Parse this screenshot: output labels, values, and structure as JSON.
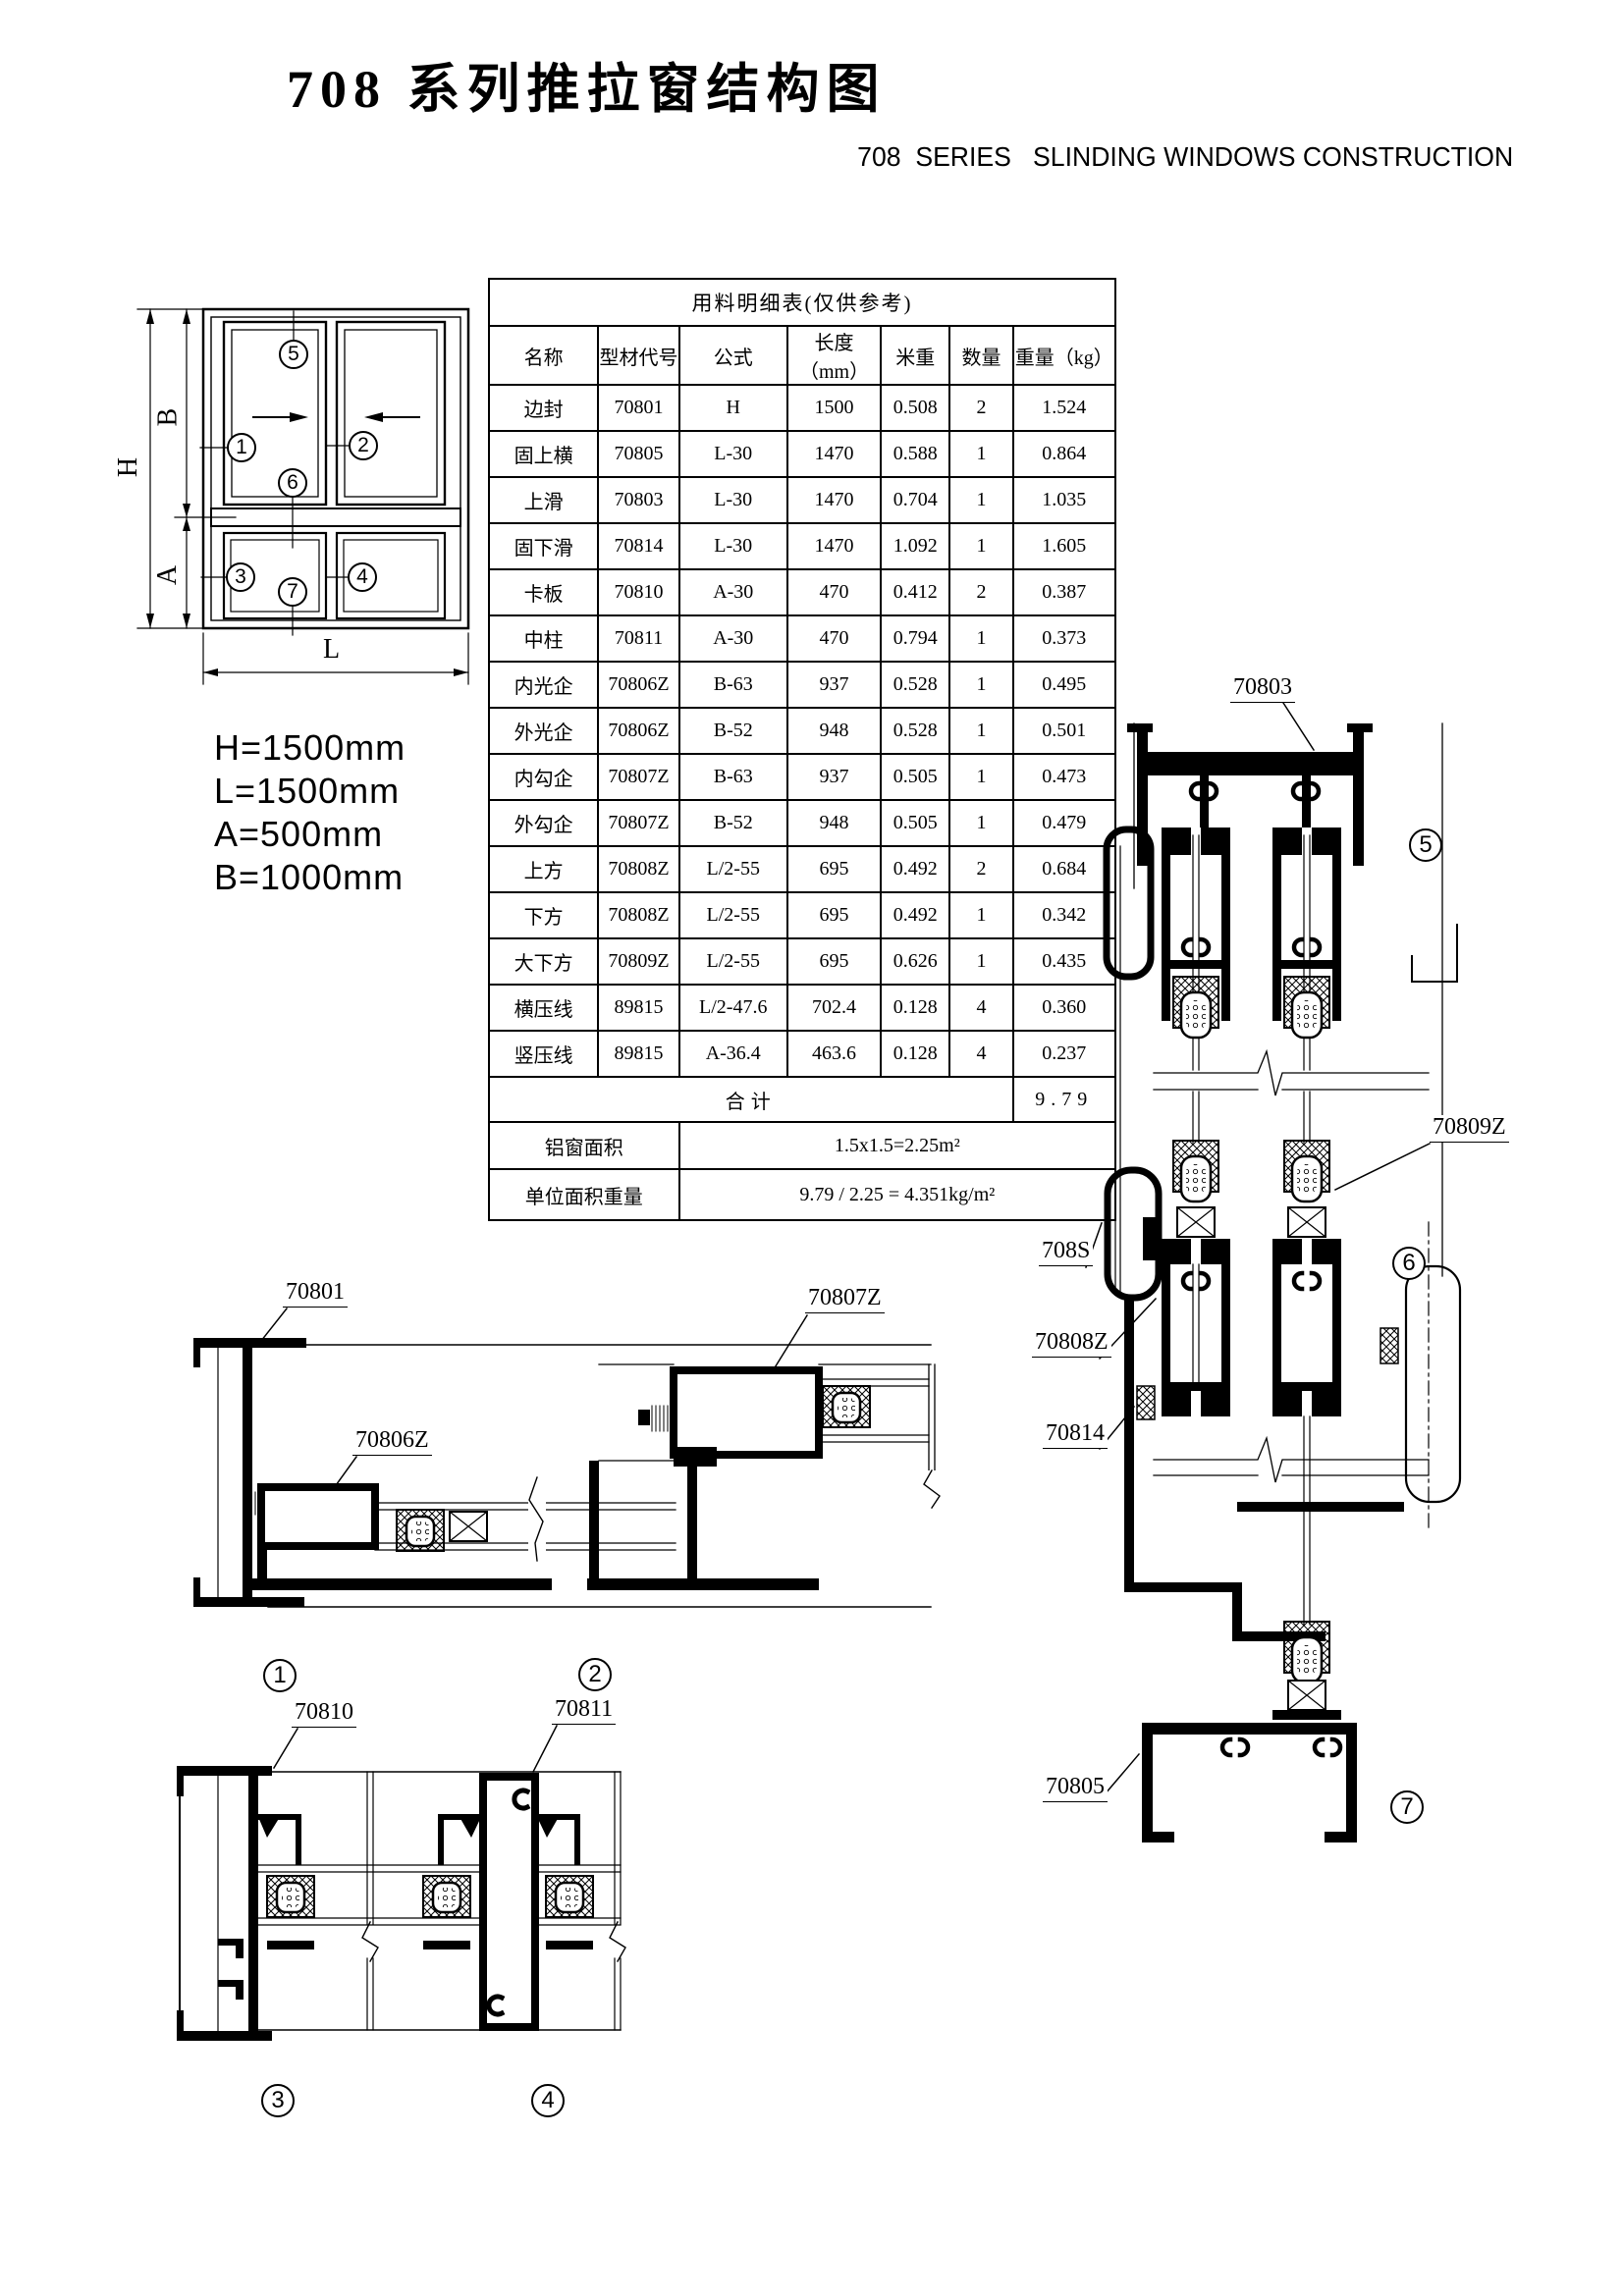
{
  "page": {
    "title": "708 系列推拉窗结构图",
    "subtitle": "708  SERIES   SLINDING WINDOWS CONSTRUCTION"
  },
  "dimensions": {
    "line1": "H=1500mm",
    "line2": "L=1500mm",
    "line3": "A=500mm",
    "line4": "B=1000mm"
  },
  "schematic": {
    "dims": {
      "h": "H",
      "b": "B",
      "a": "A",
      "l": "L"
    }
  },
  "markers": {
    "m1": "1",
    "m2": "2",
    "m3": "3",
    "m4": "4",
    "m5": "5",
    "m6": "6",
    "m7": "7"
  },
  "table": {
    "title": "用料明细表(仅供参考)",
    "headers": [
      "名称",
      "型材代号",
      "公式",
      "长度（mm）",
      "米重",
      "数量",
      "重量（kg）"
    ],
    "rows": [
      [
        "边封",
        "70801",
        "H",
        "1500",
        "0.508",
        "2",
        "1.524"
      ],
      [
        "固上横",
        "70805",
        "L-30",
        "1470",
        "0.588",
        "1",
        "0.864"
      ],
      [
        "上滑",
        "70803",
        "L-30",
        "1470",
        "0.704",
        "1",
        "1.035"
      ],
      [
        "固下滑",
        "70814",
        "L-30",
        "1470",
        "1.092",
        "1",
        "1.605"
      ],
      [
        "卡板",
        "70810",
        "A-30",
        "470",
        "0.412",
        "2",
        "0.387"
      ],
      [
        "中柱",
        "70811",
        "A-30",
        "470",
        "0.794",
        "1",
        "0.373"
      ],
      [
        "内光企",
        "70806Z",
        "B-63",
        "937",
        "0.528",
        "1",
        "0.495"
      ],
      [
        "外光企",
        "70806Z",
        "B-52",
        "948",
        "0.528",
        "1",
        "0.501"
      ],
      [
        "内勾企",
        "70807Z",
        "B-63",
        "937",
        "0.505",
        "1",
        "0.473"
      ],
      [
        "外勾企",
        "70807Z",
        "B-52",
        "948",
        "0.505",
        "1",
        "0.479"
      ],
      [
        "上方",
        "70808Z",
        "L/2-55",
        "695",
        "0.492",
        "2",
        "0.684"
      ],
      [
        "下方",
        "70808Z",
        "L/2-55",
        "695",
        "0.492",
        "1",
        "0.342"
      ],
      [
        "大下方",
        "70809Z",
        "L/2-55",
        "695",
        "0.626",
        "1",
        "0.435"
      ],
      [
        "横压线",
        "89815",
        "L/2-47.6",
        "702.4",
        "0.128",
        "4",
        "0.360"
      ],
      [
        "竖压线",
        "89815",
        "A-36.4",
        "463.6",
        "0.128",
        "4",
        "0.237"
      ]
    ],
    "total_label": "合计",
    "total_value": "9.79",
    "area_label": "铝窗面积",
    "area_value": "1.5x1.5=2.25m²",
    "unit_label": "单位面积重量",
    "unit_value": "9.79 / 2.25 = 4.351kg/m²"
  },
  "labels": {
    "p70801": "70801",
    "p70806z": "70806Z",
    "p70807z": "70807Z",
    "p70810": "70810",
    "p70811": "70811",
    "p70803": "70803",
    "p70809z": "70809Z",
    "p708s": "708S",
    "p70808z": "70808Z",
    "p70814": "70814",
    "p70805": "70805"
  }
}
